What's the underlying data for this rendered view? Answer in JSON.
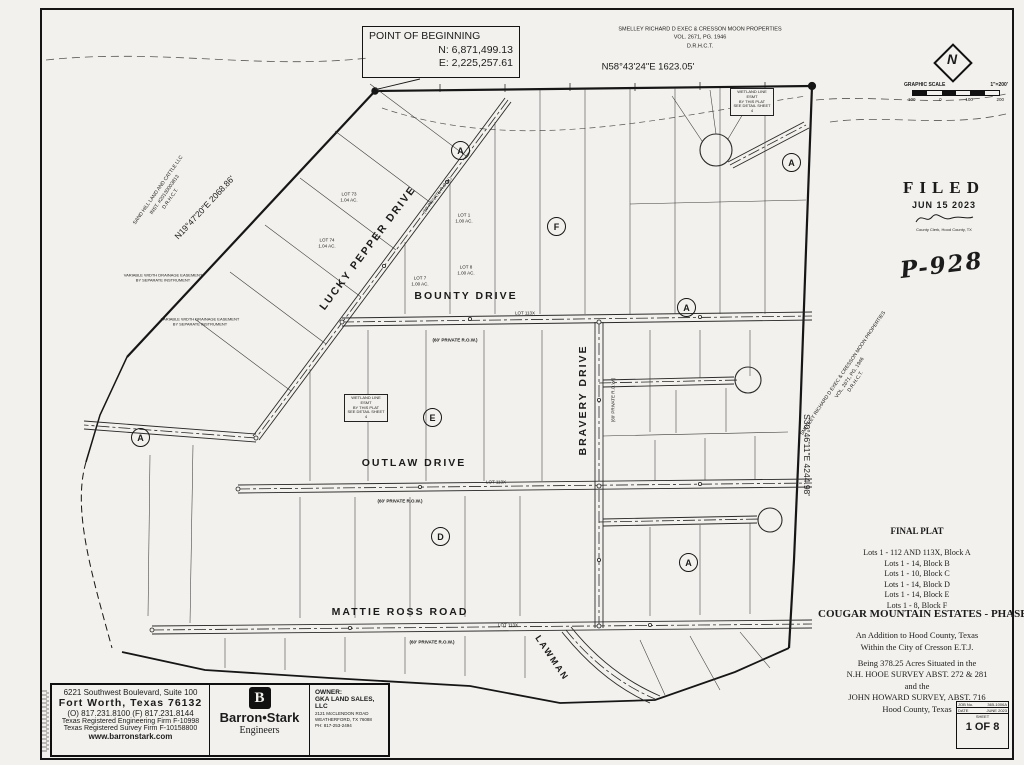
{
  "pob": {
    "title": "POINT OF BEGINNING",
    "northing": "N: 6,871,499.13",
    "easting": "E: 2,225,257.61"
  },
  "bearings": {
    "north_line": "N58°43'24\"E 1623.05'",
    "northwest_line": "N19°47'20\"E 2068.86'",
    "east_line": "S30°46'11\"E 4244.98'"
  },
  "adjoiners": {
    "north": {
      "line1": "SMELLEY RICHARD D EXEC & CRESSON MOON PROPERTIES",
      "line2": "VOL. 2671, PG. 1946",
      "line3": "D.R.H.C.T."
    },
    "east": {
      "line1": "SMELLEY RICHARD D EXEC & CRESSON MOON PROPERTIES",
      "line2": "VOL. 2671, PG. 1946",
      "line3": "D.R.H.C.T."
    },
    "west": {
      "line1": "SAND HILL LAND AND CATTLE LLC",
      "line2": "INST. #20130003813",
      "line3": "D.R.H.C.T."
    }
  },
  "north_arrow": {
    "label": "N"
  },
  "graphic_scale": {
    "title": "GRAPHIC SCALE",
    "ratio": "1\"=200'",
    "ticks": [
      "100",
      "0",
      "100",
      "200"
    ]
  },
  "filed_stamp": {
    "title": "FILED",
    "date": "JUN 15 2023",
    "clerk": "County Clerk, Hood County, TX"
  },
  "handwriting": {
    "plat_number": "P-928"
  },
  "streets": {
    "lucky_pepper": {
      "name": "LUCKY PEPPER DRIVE",
      "row": "(60' PRIVATE R.O.W.)"
    },
    "bounty": {
      "name": "BOUNTY DRIVE",
      "row": "(60' PRIVATE R.O.W.)",
      "road_lot": "LOT 113X"
    },
    "outlaw": {
      "name": "OUTLAW DRIVE",
      "row": "(60' PRIVATE R.O.W.)",
      "road_lot": "LOT 113X"
    },
    "mattie_ross": {
      "name": "MATTIE ROSS ROAD",
      "row": "(60' PRIVATE R.O.W.)",
      "road_lot": "LOT 113X"
    },
    "bravery": {
      "name": "BRAVERY DRIVE",
      "row": "(60' PRIVATE R.O.W.)"
    },
    "lawman": {
      "name": "LAWMAN"
    }
  },
  "block_labels": [
    "A",
    "F",
    "A",
    "A",
    "E",
    "A",
    "D",
    "A"
  ],
  "lots": [
    {
      "name": "LOT 73",
      "area": "1.04 AC."
    },
    {
      "name": "LOT 74",
      "area": "1.04 AC."
    },
    {
      "name": "LOT 1",
      "area": "1.00 AC."
    },
    {
      "name": "LOT 7",
      "area": "1.00 AC."
    },
    {
      "name": "LOT 8",
      "area": "1.00 AC."
    }
  ],
  "notes": {
    "detail": {
      "line1": "WETLAND LINE ESMT",
      "line2": "BY THIS PLAT",
      "line3": "SEE DETAIL SHEET 4"
    },
    "drainage": {
      "line1": "VARIABLE WIDTH DRAINAGE EASEMENT",
      "line2": "BY SEPARATE INSTRUMENT"
    }
  },
  "plat_info": {
    "final_plat": "FINAL PLAT",
    "lot_summary": [
      "Lots 1 - 112 AND 113X, Block A",
      "Lots 1 - 14, Block B",
      "Lots 1 - 10, Block C",
      "Lots 1 - 14, Block D",
      "Lots 1 - 14, Block E",
      "Lots 1 - 8,  Block F"
    ],
    "title": "COUGAR MOUNTAIN ESTATES - PHASE 1",
    "addition1": "An Addition to Hood County, Texas",
    "addition2": "Within the City of Cresson E.T.J.",
    "desc1": "Being  378.25 Acres Situated in the",
    "desc2": "N.H.  HOOE SURVEY ABST. 272 & 281",
    "desc3": "and the",
    "desc4": "JOHN HOWARD SURVEY, ABST. 716",
    "desc5": "Hood County, Texas"
  },
  "firm": {
    "address1": "6221 Southwest Boulevard, Suite 100",
    "address2": "Fort Worth, Texas 76132",
    "phones": "(O) 817.231.8100   (F) 817.231.8144",
    "eng_firm": "Texas Registered Engineering Firm F-10998",
    "survey_firm": "Texas Registered Survey Firm F-10158800",
    "website": "www.barronstark.com",
    "logo_letter": "B",
    "logo_name": "Barron•Stark",
    "logo_sub": "Engineers"
  },
  "owner": {
    "label": "OWNER:",
    "name": "GKA LAND SALES, LLC",
    "address1": "2121 McCLENDON ROAD",
    "address2": "WEATHERFORD, TX 76088",
    "phone": "PH: 817-253-2494"
  },
  "job_block": {
    "job_label": "JOB No.",
    "job_value": "365-1006A",
    "date_label": "DATE",
    "date_value": "JUNE 2023",
    "sheet_label": "SHEET",
    "sheet_value": "1 OF 8"
  }
}
